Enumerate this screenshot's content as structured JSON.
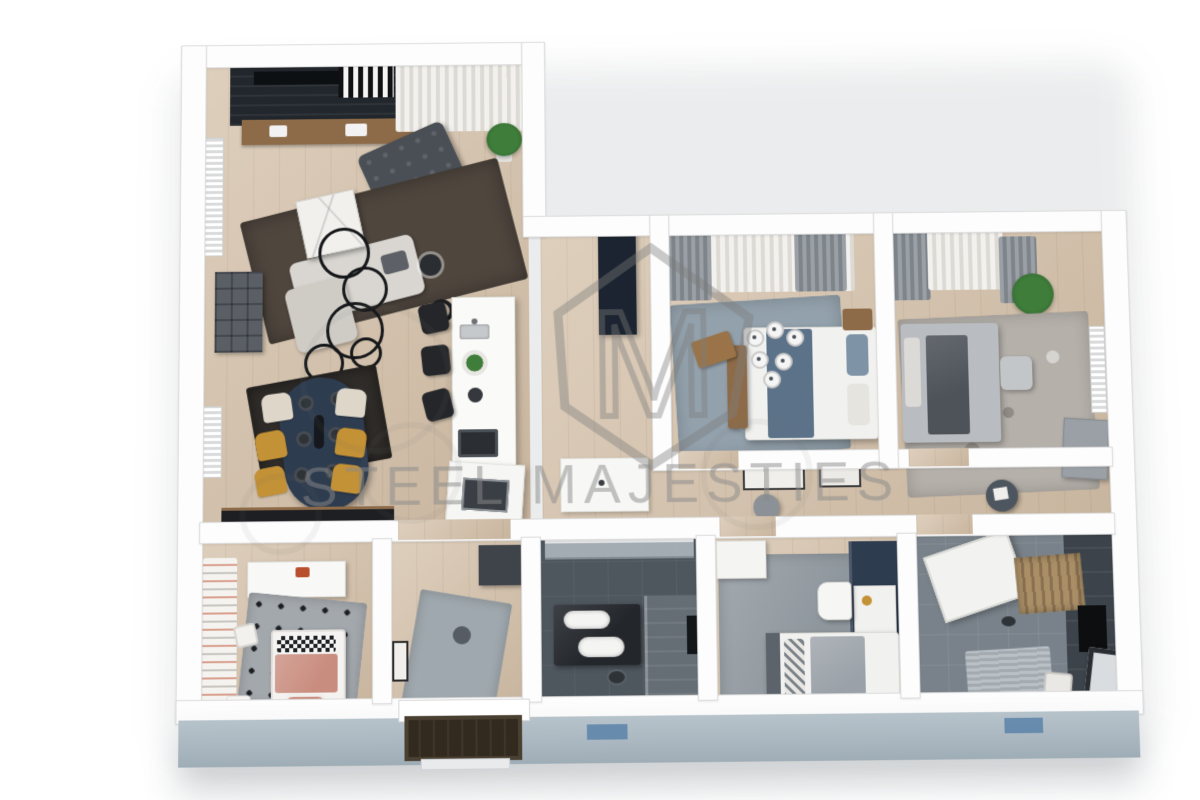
{
  "watermark": {
    "text": "STEEL MAJESTIES",
    "logo_letter": "M"
  },
  "palette": {
    "wood": "#d3bfa7",
    "wall-face": "#b7c3cb",
    "tile-dark": "#4e565e",
    "tile-mid": "#79828a",
    "navy": "#2e3c50",
    "navy-panel": "#1b2430",
    "charcoal": "#4a4f55",
    "sofa-light": "#d9d6d1",
    "rug-brown": "#4f463e",
    "marble": "#f2f0ec",
    "mustard": "#c39136",
    "cream": "#ded7c9",
    "rug-blue": "#93a1ac",
    "bed-blue": "#5c7288",
    "wood-furn": "#8d6b48",
    "rug-mottled": "#b5b0aa",
    "bed-dark": "#4e535a",
    "pink": "#c98d7f",
    "rug-polka": "#a3a8ad",
    "rug-hall": "#9fa8ae",
    "green": "#3f7d3a",
    "wm": "#8a8a8a",
    "glass": "#aeb6bd",
    "door": "#32291f",
    "mat-blue": "#5b82a8",
    "slat": "#a98e66"
  }
}
